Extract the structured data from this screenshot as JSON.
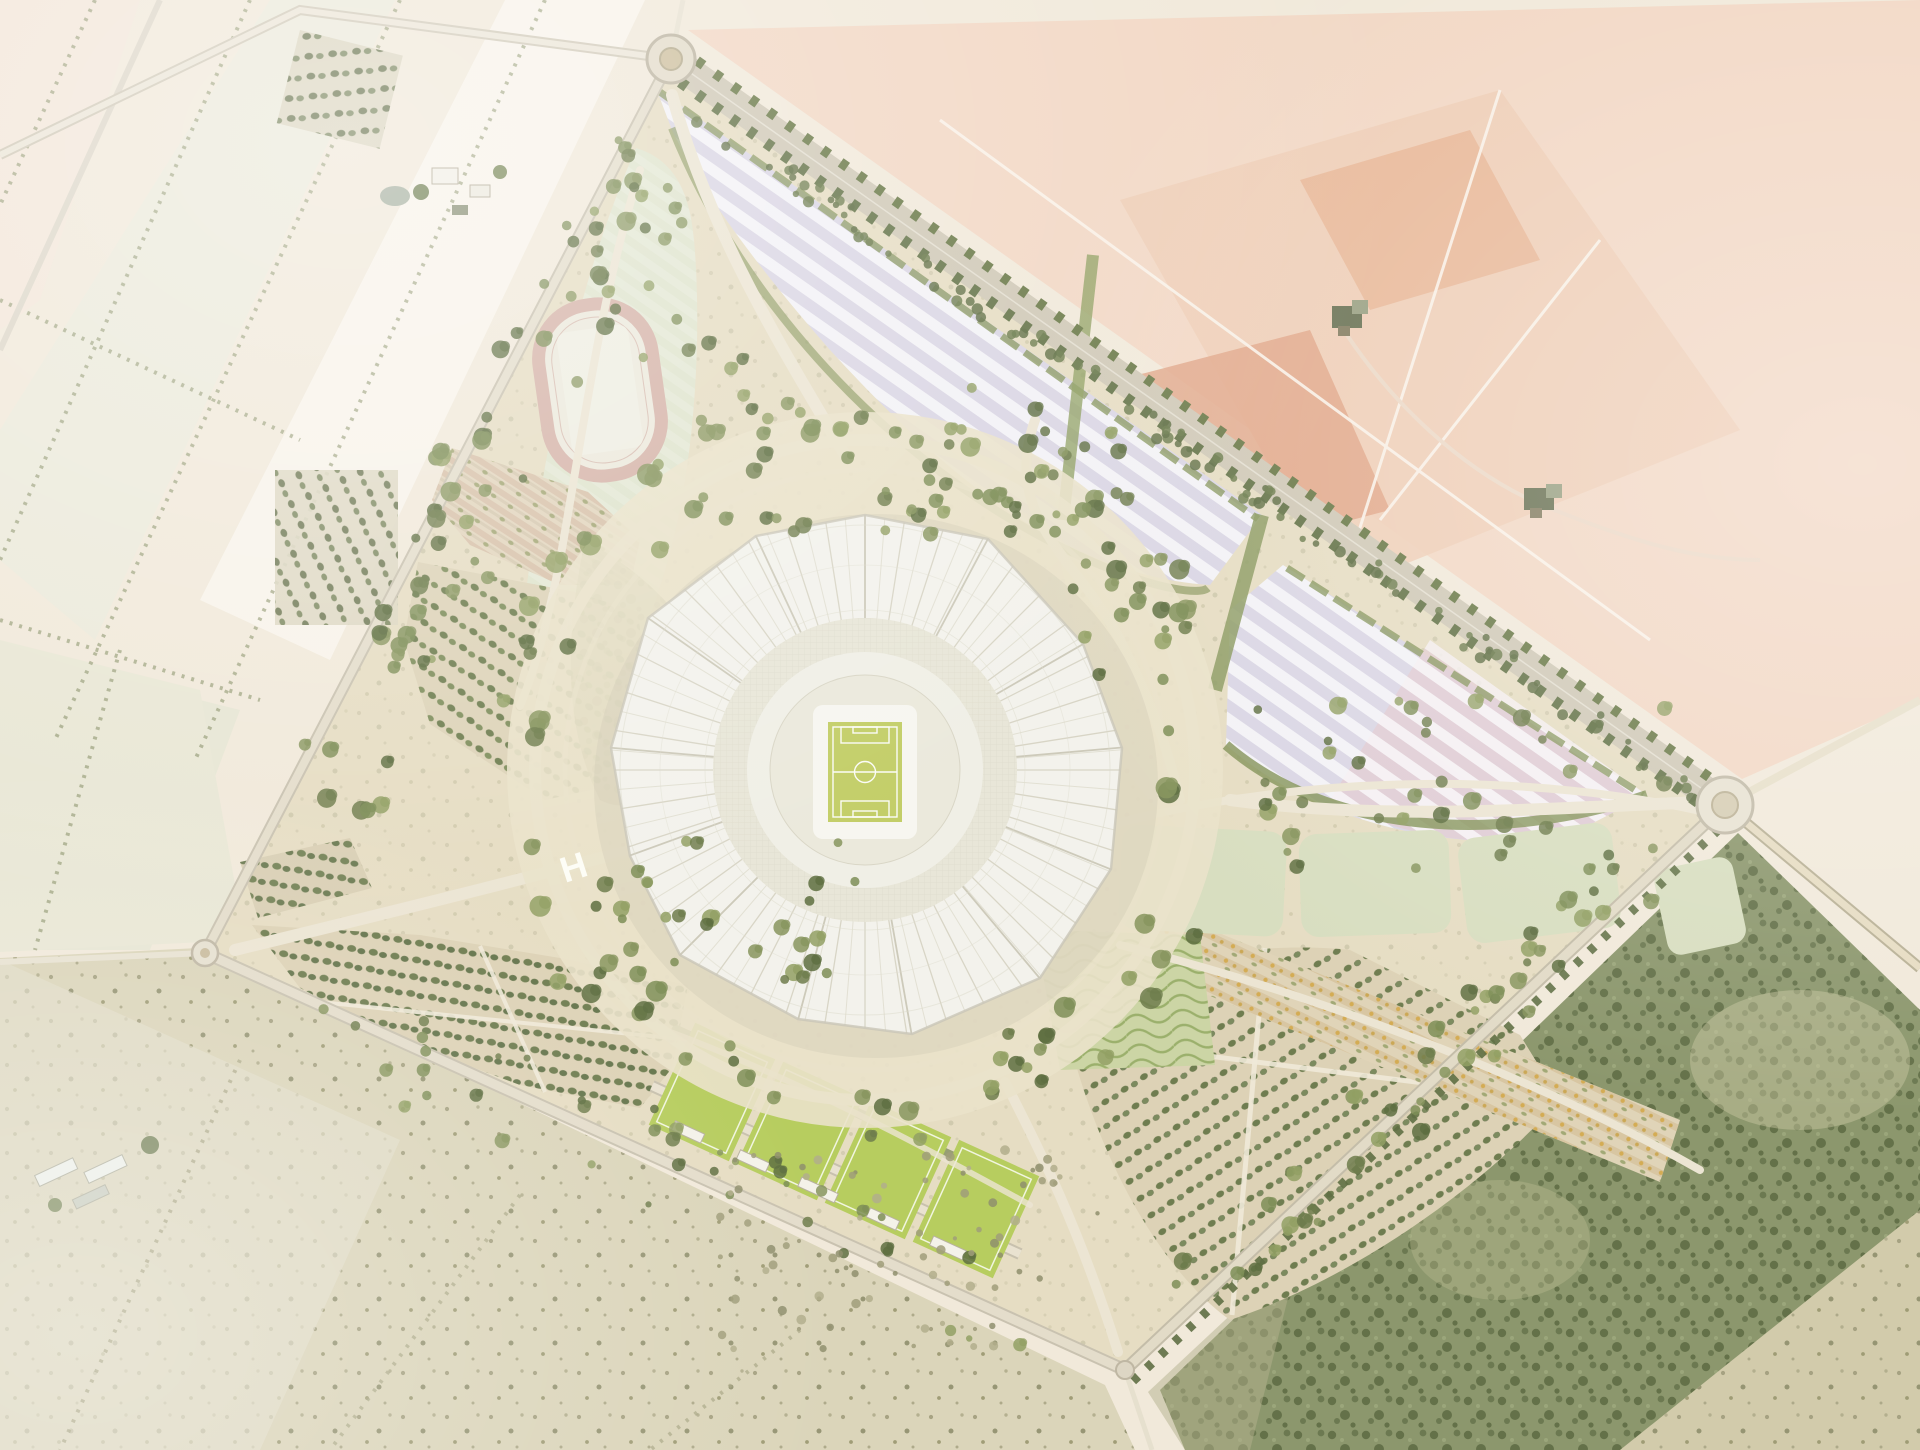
{
  "scene": {
    "title": "Aerial masterplan rendering of a stadium precinct set in farmland",
    "view": "top-down aerial",
    "site_shape": "rotated quadrilateral bounded by perimeter roads with corner roundabouts"
  },
  "helipad": {
    "label": "H"
  },
  "features": {
    "stadium": "central stadium with white radial canopy roof and football pitch",
    "running_track": "athletics running track on lawn fan, north-west quadrant",
    "parking_north": "striped parking grove with photovoltaic canopies along north-east boulevard",
    "parking_east": "striped parking grove with photovoltaic canopies near east corner",
    "event_lawns": "row of pale green event lawns, east quadrant",
    "orchard_west": "orchard rows inside western edge",
    "orchard_southwest": "dotted orchard grid north of west corner",
    "orchard_southeast": "fan-shaped dotted orchard grid, south-east quadrant",
    "orchard_band_east": "flowering orchard band with yellow accents",
    "meadow_waves": "wavy planted meadow south-east of stadium",
    "training_grounds": "four training pitches with pavilion buildings, south quadrant",
    "helipad": "white H helipad marking on western esplanade",
    "boulevard": "tree-lined double boulevard on north-east edge",
    "roundabout_north": "roundabout at north corner",
    "roundabout_east": "roundabout at east corner",
    "roundabout_west": "roundabout at west corner",
    "grove_southeast": "dense existing grove outside south-east edge",
    "farmland_northwest": "pale farmland parcels with hedgerows and farm buildings",
    "farmland_northeast": "salmon and terracotta ploughed fields with two farmsteads",
    "scrub_southwest": "sparse scrubland fields"
  },
  "colors": {
    "sand": "#e6ddc3",
    "plaza": "#eae2ca",
    "canopy": "#f3f2ec",
    "canopy_line": "#d8d5c6",
    "bowl": "#e8e6d8",
    "pitch": "#c3ce68",
    "pitch_line": "#ffffff",
    "training_pitch": "#b7cd5f",
    "track": "#d6b4a9",
    "track_infield": "#efeee2",
    "lawn": "#dfe4cd",
    "event_lawn": "#d8dec0",
    "parking_a": "#dad6e4",
    "parking_b": "#f3f2f6",
    "parking_pink": "#e2cbd1",
    "orchard_dot": "#69794b",
    "orchard_row_pink": "#d7c1a9",
    "road": "#d7d0bf",
    "path": "#ece5d3",
    "tree": "#75854f",
    "tree_dark": "#5e6e41",
    "forest": "#8c976d",
    "forest_dot": "#5d6a43",
    "farm_cream": "#f1e9da",
    "farm_salmon": "#f2d8c5",
    "farm_terracotta": "#e0a687",
    "scrub": "#dbd5ba"
  }
}
